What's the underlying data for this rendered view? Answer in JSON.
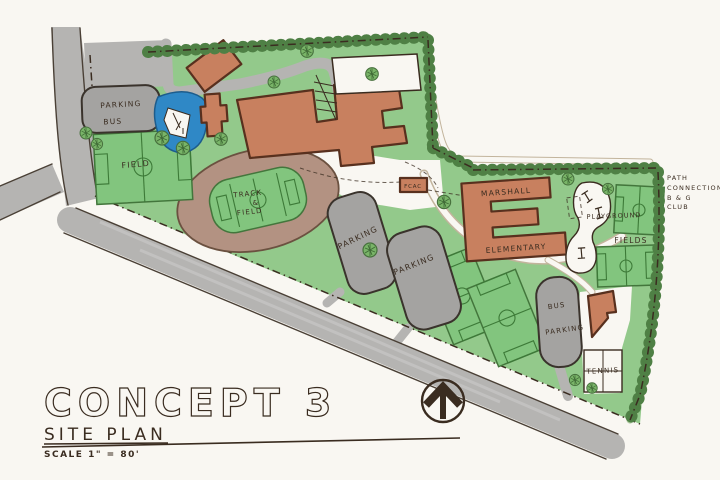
{
  "title": {
    "main": "CONCEPT 3",
    "subtitle": "SITE PLAN",
    "scale": "SCALE  1\" = 80'"
  },
  "areas": {
    "parking_nw": {
      "line1": "PARKING",
      "line2": "BUS"
    },
    "field_w": "FIELD",
    "track": {
      "line1": "TRACK",
      "line2": "&",
      "line3": "FIELD"
    },
    "parking_a": "PARKING",
    "parking_b": "PARKING",
    "fcac": "FCAC",
    "school": {
      "line1": "MARSHALL",
      "line2": "ELEMENTARY"
    },
    "playground": "PLAYGROUND",
    "fields_e": "FIELDS",
    "bus_parking": {
      "line1": "BUS",
      "line2": "PARKING"
    },
    "tennis": "TENNIS",
    "path_note": {
      "line1": "PATH",
      "line2": "CONNECTION",
      "line3": "B & G",
      "line4": "CLUB"
    }
  },
  "colors": {
    "paper": "#f9f7f2",
    "green": "#93c98b",
    "field_green": "#82c57e",
    "hedge": "#4f8045",
    "road": "#b5b4b2",
    "parking": "#a4a3a1",
    "building": "#c8805f",
    "track": "#b39282",
    "water": "#2f88c6",
    "ink": "#3a2c20"
  }
}
